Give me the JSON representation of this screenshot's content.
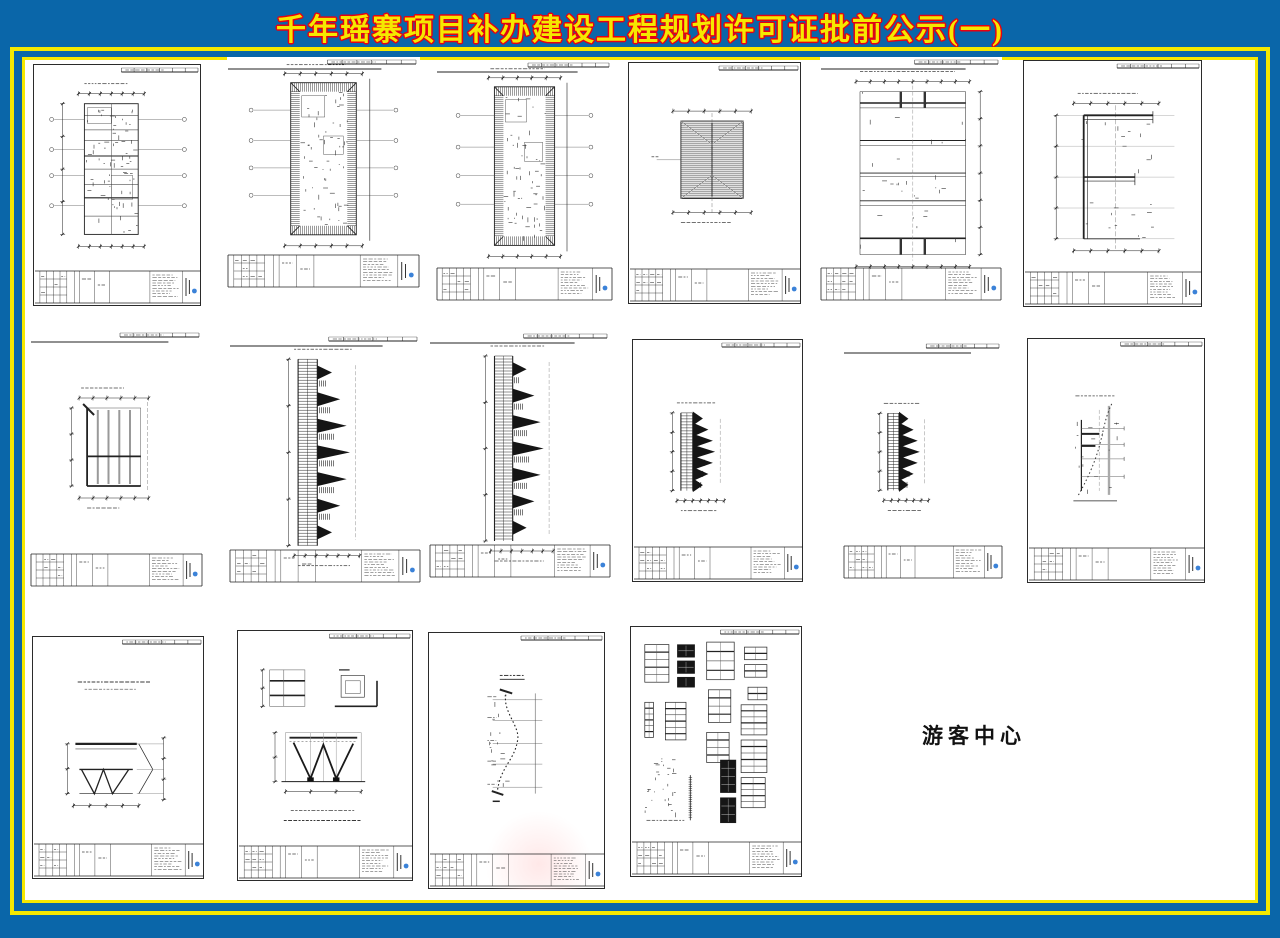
{
  "page": {
    "title": "千年瑶寨项目补办建设工程规划许可证批前公示(一)",
    "visitor_center_label": "游客中心",
    "colors": {
      "background_blue": "#0a66a9",
      "frame_yellow": "#f5e800",
      "title_fill_yellow": "#f5e800",
      "title_outline_red": "#e60012",
      "sheet_line_dark": "#222222",
      "sheet_line_gray": "#555555",
      "stamp_blue": "#3b82d8",
      "watermark_pink": "#ffdede"
    }
  },
  "sheets": [
    {
      "id": "sheet-01",
      "row": 1,
      "col": 1,
      "type": "plan-tall",
      "description": "tall floor plan with column grid and dimension strings",
      "bordered": true,
      "x": 33,
      "y": 64,
      "w": 168,
      "h": 242
    },
    {
      "id": "sheet-02",
      "row": 1,
      "col": 2,
      "type": "plan-hatched",
      "description": "floor plan with hatched tile-roof border",
      "bordered": false,
      "x": 227,
      "y": 57,
      "w": 193,
      "h": 234
    },
    {
      "id": "sheet-03",
      "row": 1,
      "col": 3,
      "type": "plan-hatched",
      "description": "floor plan with hatched tile-roof border",
      "bordered": false,
      "x": 436,
      "y": 60,
      "w": 177,
      "h": 244
    },
    {
      "id": "sheet-04",
      "row": 1,
      "col": 4,
      "type": "roof-square",
      "description": "square hip roof plan with dense hatching",
      "bordered": true,
      "x": 628,
      "y": 62,
      "w": 173,
      "h": 242
    },
    {
      "id": "sheet-05",
      "row": 1,
      "col": 5,
      "type": "framing",
      "description": "framing plan with long horizontal members and paired columns",
      "bordered": false,
      "x": 820,
      "y": 57,
      "w": 182,
      "h": 247
    },
    {
      "id": "sheet-06",
      "row": 1,
      "col": 6,
      "type": "foundation",
      "description": "foundation beam plan with E-shaped layout",
      "bordered": true,
      "x": 1023,
      "y": 60,
      "w": 179,
      "h": 247
    },
    {
      "id": "sheet-07",
      "row": 2,
      "col": 1,
      "type": "grid-plan",
      "description": "square framing grid plan",
      "bordered": false,
      "x": 30,
      "y": 330,
      "w": 173,
      "h": 260
    },
    {
      "id": "sheet-08",
      "row": 2,
      "col": 2,
      "type": "pagoda-large",
      "description": "tiered pagoda elevation rotated sideways, large",
      "bordered": false,
      "x": 229,
      "y": 334,
      "w": 192,
      "h": 252
    },
    {
      "id": "sheet-09",
      "row": 2,
      "col": 3,
      "type": "pagoda-large",
      "description": "tiered pagoda elevation rotated sideways, large",
      "bordered": false,
      "x": 429,
      "y": 331,
      "w": 182,
      "h": 250
    },
    {
      "id": "sheet-10",
      "row": 2,
      "col": 4,
      "type": "pagoda-small",
      "description": "tiered pagoda elevation rotated sideways, small",
      "bordered": true,
      "x": 632,
      "y": 339,
      "w": 171,
      "h": 243
    },
    {
      "id": "sheet-11",
      "row": 2,
      "col": 5,
      "type": "pagoda-small",
      "description": "tiered pagoda elevation rotated sideways, small",
      "bordered": false,
      "x": 843,
      "y": 341,
      "w": 160,
      "h": 241
    },
    {
      "id": "sheet-12",
      "row": 2,
      "col": 6,
      "type": "section-small",
      "description": "small section detail drawing",
      "bordered": true,
      "x": 1027,
      "y": 338,
      "w": 178,
      "h": 245
    },
    {
      "id": "sheet-13",
      "row": 3,
      "col": 1,
      "type": "truss-section",
      "description": "roof truss section with V webs",
      "bordered": true,
      "x": 32,
      "y": 636,
      "w": 172,
      "h": 243
    },
    {
      "id": "sheet-14",
      "row": 3,
      "col": 2,
      "type": "truss-detail",
      "description": "W truss detail with two sub-details",
      "bordered": true,
      "x": 237,
      "y": 630,
      "w": 176,
      "h": 251
    },
    {
      "id": "sheet-15",
      "row": 3,
      "col": 3,
      "type": "curve-profile",
      "description": "curved roof profile section",
      "bordered": true,
      "watermark": true,
      "x": 428,
      "y": 632,
      "w": 177,
      "h": 257
    },
    {
      "id": "sheet-16",
      "row": 3,
      "col": 4,
      "type": "schedule",
      "description": "door and window schedule sheet with many small tables",
      "bordered": true,
      "x": 630,
      "y": 626,
      "w": 172,
      "h": 251
    }
  ]
}
